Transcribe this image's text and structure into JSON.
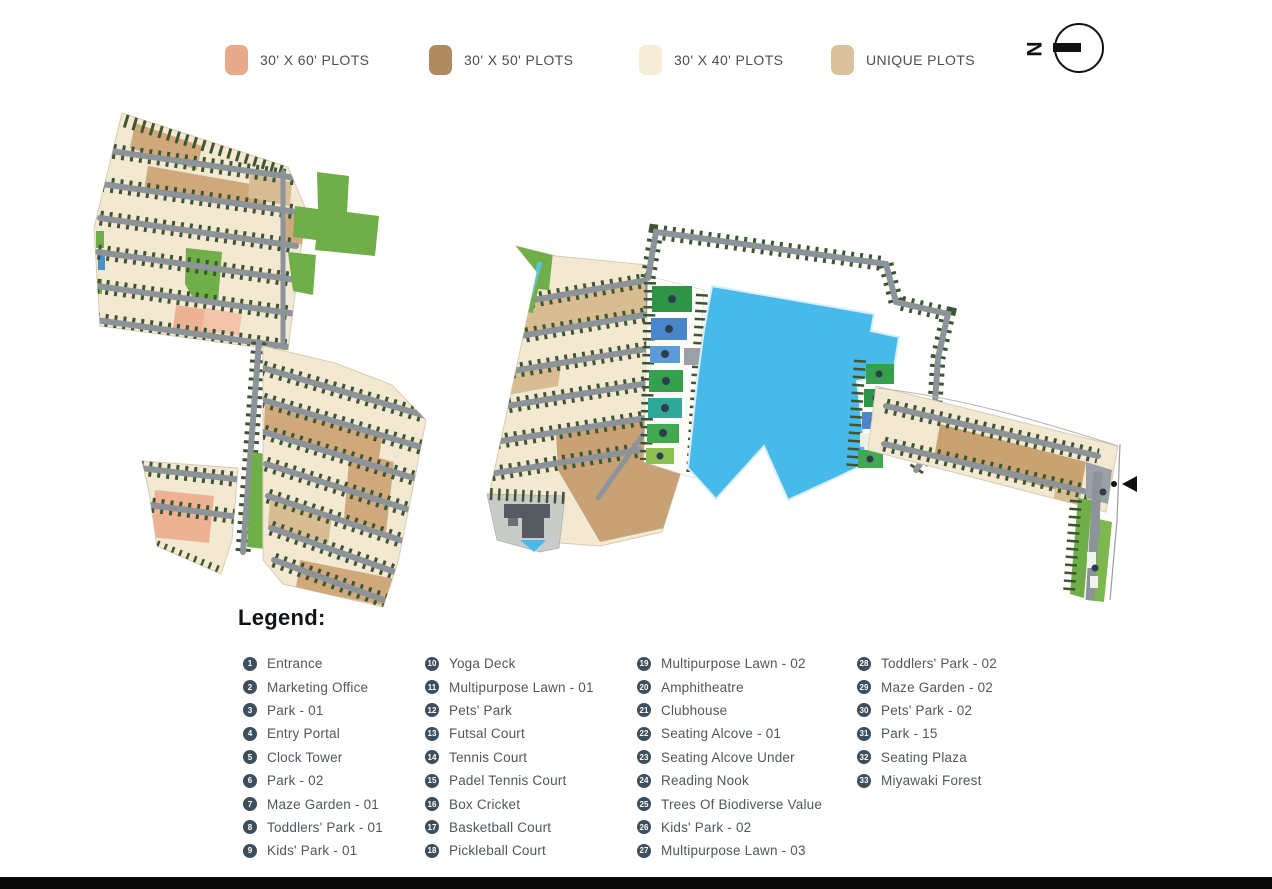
{
  "plot_legend": {
    "items": [
      {
        "label": "30' X 60' PLOTS",
        "color": "#e8a98a"
      },
      {
        "label": "30' X 50' PLOTS",
        "color": "#b08a60"
      },
      {
        "label": "30' X 40' PLOTS",
        "color": "#f6ecd8"
      },
      {
        "label": "UNIQUE PLOTS",
        "color": "#dcc29c"
      }
    ]
  },
  "compass": {
    "label": "N"
  },
  "legend": {
    "title": "Legend:",
    "columns": [
      {
        "items": [
          {
            "num": "1",
            "label": "Entrance"
          },
          {
            "num": "2",
            "label": "Marketing Office"
          },
          {
            "num": "3",
            "label": "Park - 01"
          },
          {
            "num": "4",
            "label": "Entry Portal"
          },
          {
            "num": "5",
            "label": "Clock Tower"
          },
          {
            "num": "6",
            "label": "Park - 02"
          },
          {
            "num": "7",
            "label": "Maze Garden - 01"
          },
          {
            "num": "8",
            "label": "Toddlers' Park - 01"
          },
          {
            "num": "9",
            "label": "Kids' Park - 01"
          }
        ]
      },
      {
        "items": [
          {
            "num": "10",
            "label": "Yoga Deck"
          },
          {
            "num": "11",
            "label": "Multipurpose Lawn - 01"
          },
          {
            "num": "12",
            "label": "Pets' Park"
          },
          {
            "num": "13",
            "label": "Futsal Court"
          },
          {
            "num": "14",
            "label": "Tennis Court"
          },
          {
            "num": "15",
            "label": "Padel Tennis Court"
          },
          {
            "num": "16",
            "label": "Box Cricket"
          },
          {
            "num": "17",
            "label": "Basketball Court"
          },
          {
            "num": "18",
            "label": "Pickleball Court"
          }
        ]
      },
      {
        "items": [
          {
            "num": "19",
            "label": "Multipurpose Lawn - 02"
          },
          {
            "num": "20",
            "label": "Amphitheatre"
          },
          {
            "num": "21",
            "label": "Clubhouse"
          },
          {
            "num": "22",
            "label": "Seating Alcove - 01"
          },
          {
            "num": "23",
            "label": "Seating Alcove Under"
          },
          {
            "num": "24",
            "label": "Reading Nook"
          },
          {
            "num": "25",
            "label": "Trees Of Biodiverse Value"
          },
          {
            "num": "26",
            "label": "Kids' Park - 02"
          },
          {
            "num": "27",
            "label": "Multipurpose Lawn - 03"
          }
        ]
      },
      {
        "items": [
          {
            "num": "28",
            "label": "Toddlers' Park - 02"
          },
          {
            "num": "29",
            "label": "Maze Garden - 02"
          },
          {
            "num": "30",
            "label": "Pets' Park - 02"
          },
          {
            "num": "31",
            "label": "Park - 15"
          },
          {
            "num": "32",
            "label": "Seating Plaza"
          },
          {
            "num": "33",
            "label": "Miyawaki Forest"
          }
        ]
      }
    ]
  },
  "map": {
    "colors": {
      "plot_cream": "#f3e8d2",
      "plot_tan": "#cfa97b",
      "plot_salmon": "#edb193",
      "park_green": "#6fae49",
      "hedge_green": "#3f5532",
      "road_gray": "#8c949a",
      "lake_blue": "#47bae9",
      "stream_teal": "#5fc4d0",
      "court_green": "#2e9447",
      "court_blue": "#4a86cc",
      "court_teal": "#2fa89a",
      "lawn_green": "#8cc152",
      "clubhouse_gray": "#555b60"
    }
  }
}
